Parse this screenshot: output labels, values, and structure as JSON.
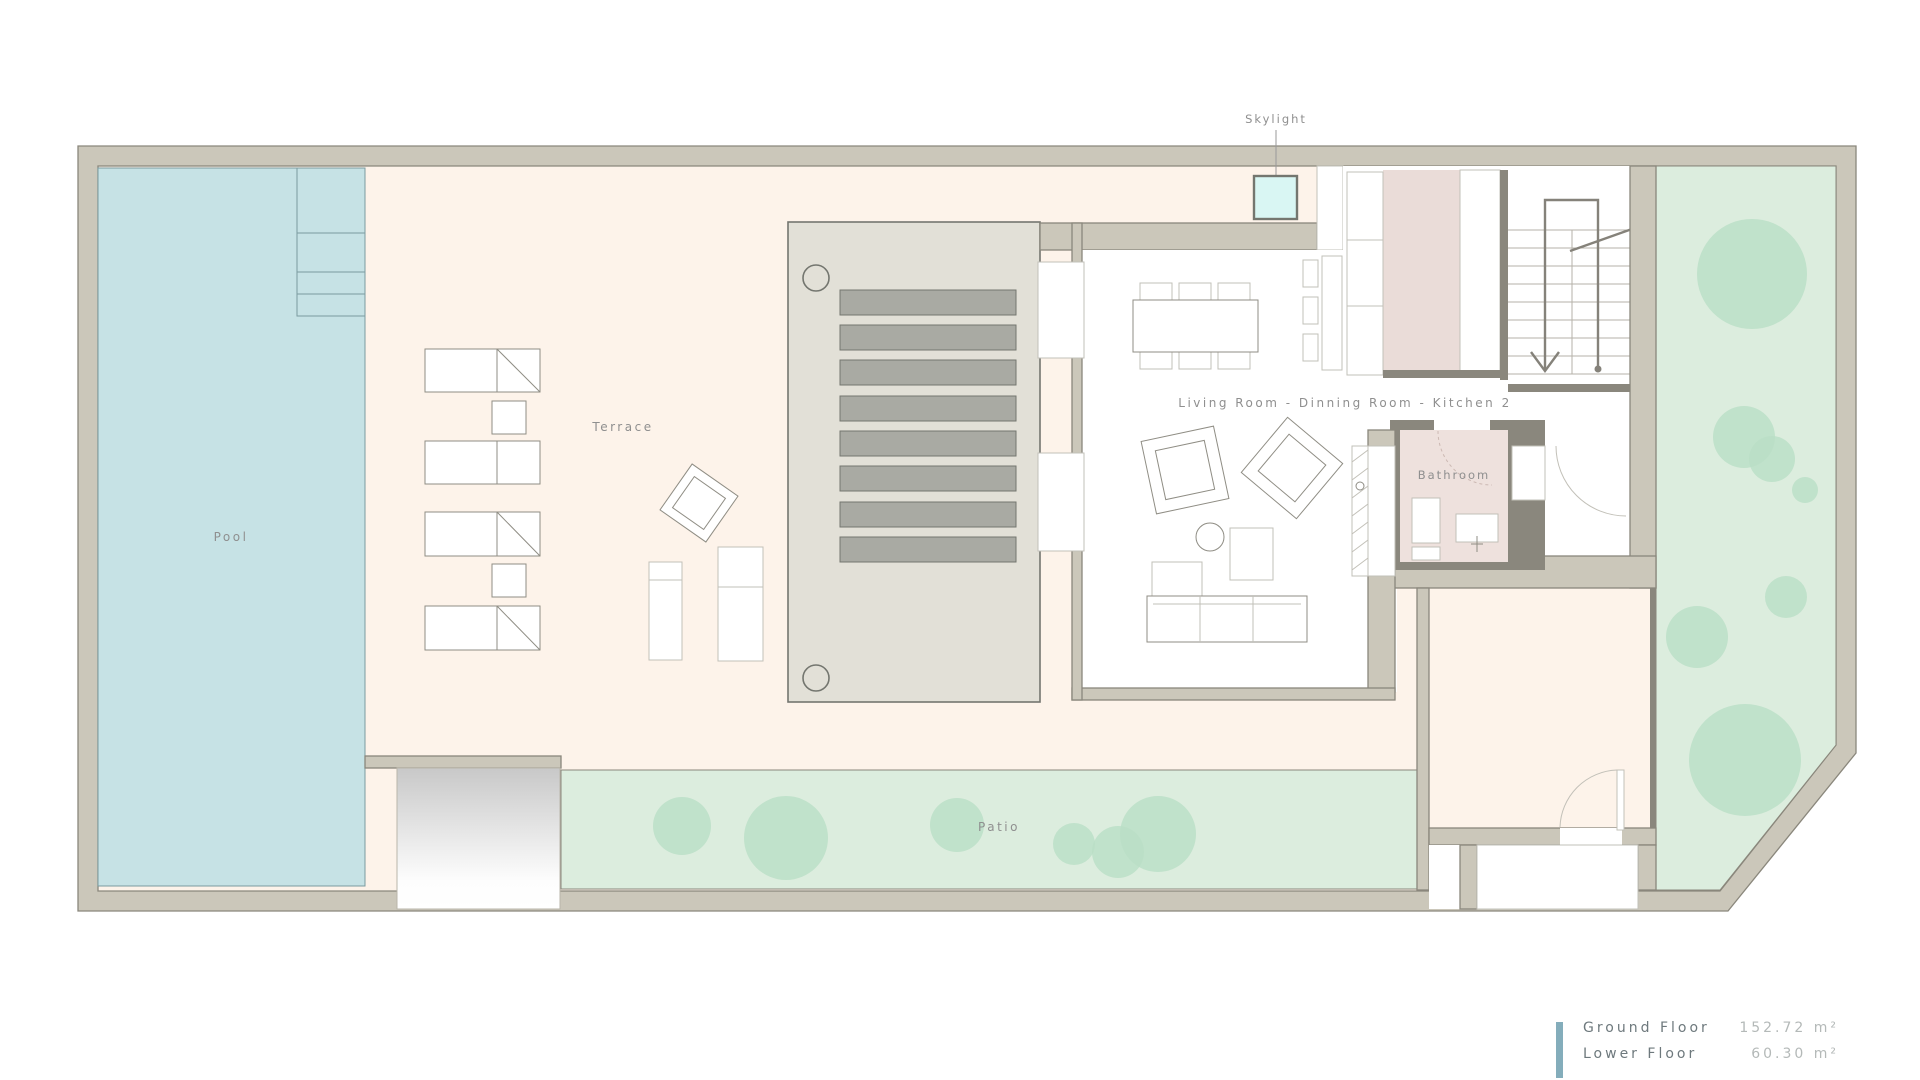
{
  "plan": {
    "labels": {
      "pool": "Pool",
      "terrace": "Terrace",
      "patio": "Patio",
      "skylight": "Skylight",
      "bathroom": "Bathroom",
      "living_area": "Living Room - Dinning Room - Kitchen 2"
    }
  },
  "legend": {
    "rows": [
      {
        "label": "Ground Floor",
        "value": "152.72 m²"
      },
      {
        "label": "Lower Floor",
        "value": "60.30 m²"
      }
    ]
  },
  "colors": {
    "wall_fill": "#cbc7ba",
    "wall_stroke": "#8a877c",
    "interior_wall": "#8a877d",
    "floor_cream": "#fdf3ea",
    "pool_water": "#c6e2e5",
    "pool_line": "#7b9ba0",
    "lawn_green": "#dcedde",
    "tree_green": "#b9dfc5",
    "deck_gray": "#e2e0d7",
    "slat_gray": "#a9aaa3",
    "slat_stroke": "#74766f",
    "skylight_cyan": "#d9f6f3",
    "kitchen_pink": "#eadcd8",
    "bath_pink": "#eee1dd",
    "furniture_stroke": "#8f8d84",
    "light_stroke": "#c2c0b8",
    "label_text": "#8f8f8f",
    "legend_accent": "#84adbb",
    "legend_label": "#6e797d",
    "legend_value": "#b4b9b8",
    "ramp_gray": "#c8c8c8"
  }
}
